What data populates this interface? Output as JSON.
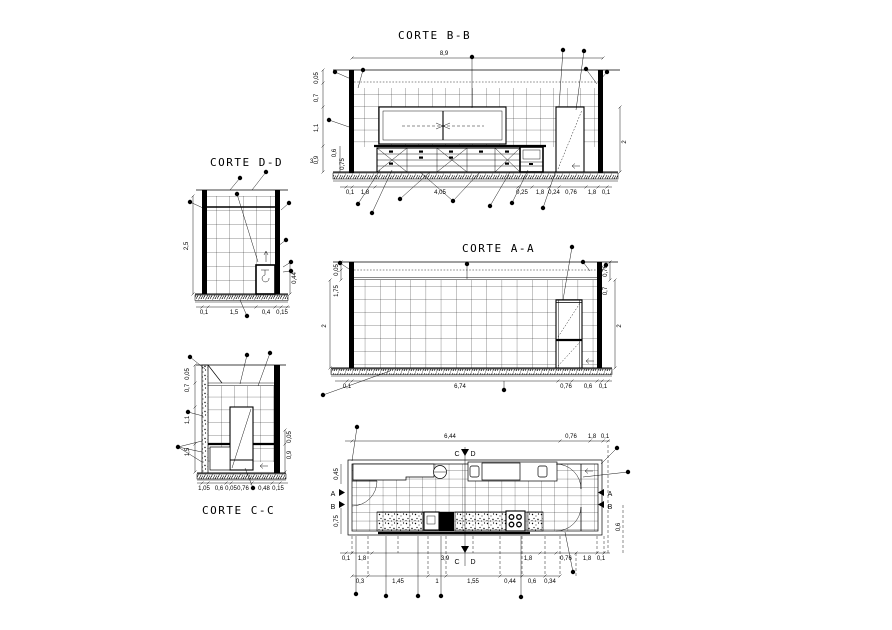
{
  "drawing": {
    "type": "architectural-cad-kitchen-sections",
    "ink": "#000000",
    "background": "#ffffff",
    "sections": {
      "bb": {
        "title": "CORTE B-B",
        "dim_top": "8,9",
        "dim_right": "2",
        "left": [
          "0,05",
          "0,7",
          "1,1",
          "0,9"
        ],
        "left_inner": [
          "0,6",
          "0,75"
        ],
        "bottom": [
          "0,1",
          "1,8",
          "4,05",
          "0,25",
          "1,8",
          "0,24",
          "0,76",
          "1,8",
          "0,1"
        ]
      },
      "dd": {
        "title": "CORTE D-D",
        "callout": "3",
        "dim_left": "2,5",
        "dim_right": "0,44",
        "bottom": [
          "0,1",
          "1,5",
          "0,4",
          "0,15"
        ]
      },
      "aa": {
        "title": "CORTE A-A",
        "left": [
          "0,05",
          "1,75"
        ],
        "dim_left_main": "2",
        "right": [
          "0,76",
          "0,7"
        ],
        "dim_right_main": "2",
        "bottom": [
          "0,1",
          "6,74",
          "0,76",
          "0,6",
          "0,1"
        ]
      },
      "cc": {
        "title": "CORTE C-C",
        "left": [
          "0,05",
          "0,7",
          "1,1",
          "1,5"
        ],
        "right": [
          "0,05",
          "0,9"
        ],
        "bottom": [
          "1,05",
          "0,6",
          "0,05",
          "0,76",
          "0,48",
          "0,15"
        ]
      },
      "plan": {
        "cut_label_c": "C",
        "cut_label_d": "D",
        "marker_a": "A",
        "marker_b": "B",
        "top": [
          "6,44",
          "0,76",
          "1,8",
          "0,1"
        ],
        "row1": [
          "0,1",
          "1,8",
          "3,9",
          "1,8",
          "0,76",
          "1,8",
          "0,1"
        ],
        "row2": [
          "0,3",
          "1,45",
          "1",
          "1,55",
          "0,44",
          "0,6",
          "0,34"
        ],
        "left": [
          "0,45",
          "0,75"
        ],
        "right": [
          "0,6"
        ]
      }
    }
  }
}
